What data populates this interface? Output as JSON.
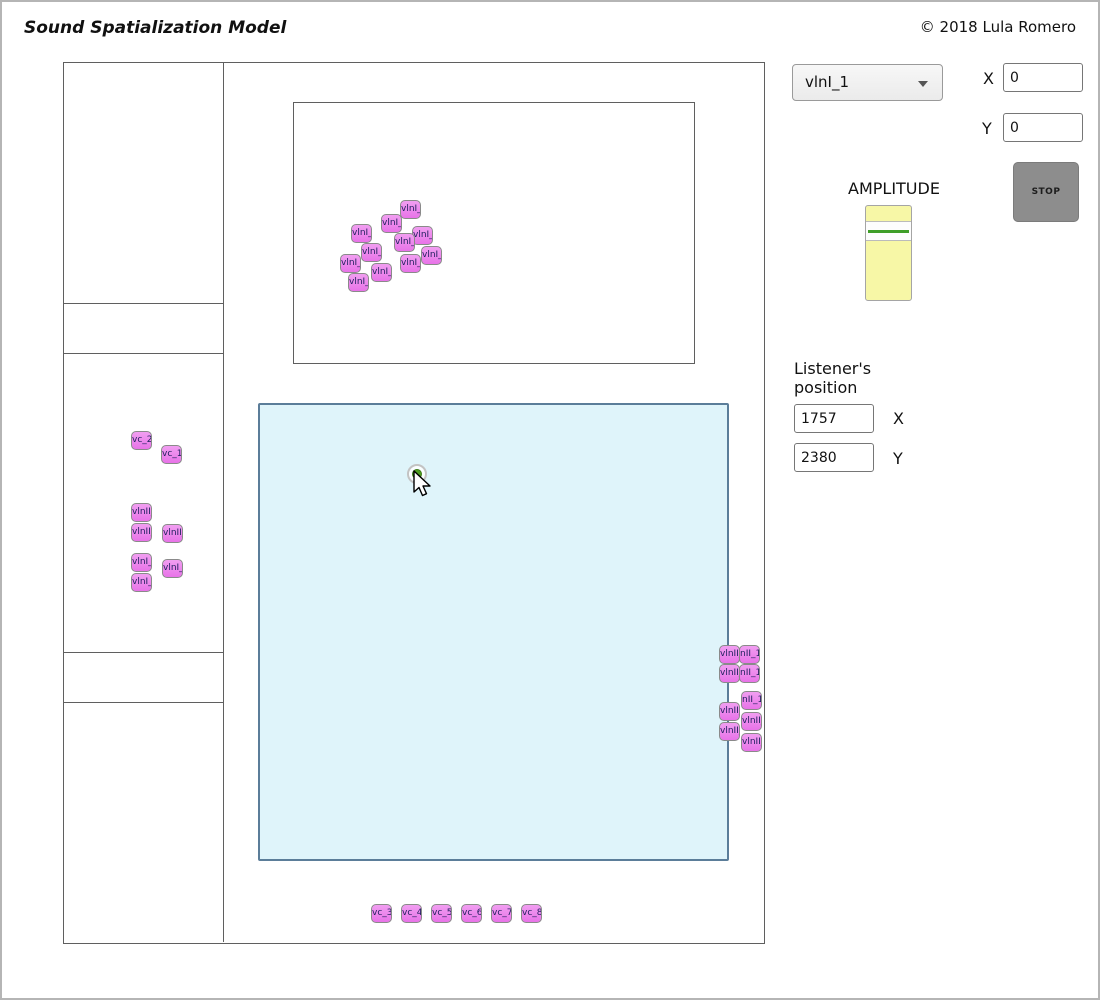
{
  "header": {
    "title": "Sound Spatialization Model",
    "copyright": "© 2018 Lula Romero"
  },
  "source_panel": {
    "selected_source": "vlnI_1",
    "x_label": "X",
    "x_value": "0",
    "y_label": "Y",
    "y_value": "0",
    "amplitude_label": "AMPLITUDE",
    "stop_label": "STOP"
  },
  "listener_panel": {
    "heading": "Listener's position",
    "x_label": "X",
    "x_value": "1757",
    "y_label": "Y",
    "y_value": "2380"
  },
  "colors": {
    "object_fill": "#ee82ee",
    "object_border": "#8a8a8a",
    "object_text": "#1f1f5e",
    "stage_fill": "#dff4fa",
    "stage_border": "#5b7d99",
    "slider_fill": "#f7f7a6",
    "slider_handle_line": "#3f9e28",
    "stop_fill": "#8d8d8d",
    "marker_dot": "#4e9e20",
    "frame_line": "#5f5f5f"
  },
  "sound_objects": [
    {
      "label": "vlnI_1",
      "x": 398,
      "y": 198
    },
    {
      "label": "vlnI_1",
      "x": 379,
      "y": 212
    },
    {
      "label": "vlnI_1",
      "x": 349,
      "y": 222
    },
    {
      "label": "vlnI_1",
      "x": 410,
      "y": 224
    },
    {
      "label": "vlnI_1",
      "x": 392,
      "y": 231
    },
    {
      "label": "vlnI_9",
      "x": 359,
      "y": 241
    },
    {
      "label": "vlnI_7",
      "x": 419,
      "y": 244
    },
    {
      "label": "vlnI_8",
      "x": 338,
      "y": 252
    },
    {
      "label": "vlnI_6",
      "x": 398,
      "y": 252
    },
    {
      "label": "vlnI_5",
      "x": 369,
      "y": 261
    },
    {
      "label": "vlnI_4",
      "x": 346,
      "y": 271
    },
    {
      "label": "vc_2",
      "x": 129,
      "y": 429
    },
    {
      "label": "vc_1",
      "x": 159,
      "y": 443
    },
    {
      "label": "vlnII_3",
      "x": 129,
      "y": 501
    },
    {
      "label": "vlnII_2",
      "x": 129,
      "y": 521
    },
    {
      "label": "vlnII_1",
      "x": 160,
      "y": 522
    },
    {
      "label": "vlnI_3",
      "x": 129,
      "y": 551
    },
    {
      "label": "vlnI_2",
      "x": 129,
      "y": 571
    },
    {
      "label": "vlnI_1",
      "x": 160,
      "y": 557
    },
    {
      "label": "vlnII_1",
      "x": 717,
      "y": 643
    },
    {
      "label": "nII_1",
      "x": 737,
      "y": 643
    },
    {
      "label": "vlnII_4",
      "x": 717,
      "y": 662
    },
    {
      "label": "nII_1",
      "x": 737,
      "y": 662
    },
    {
      "label": "nII_1",
      "x": 739,
      "y": 689
    },
    {
      "label": "vlnII_5",
      "x": 717,
      "y": 700
    },
    {
      "label": "vlnII_9",
      "x": 739,
      "y": 710
    },
    {
      "label": "vlnII_4",
      "x": 717,
      "y": 720
    },
    {
      "label": "vlnII_8",
      "x": 739,
      "y": 731
    },
    {
      "label": "vc_3",
      "x": 369,
      "y": 902
    },
    {
      "label": "vc_4",
      "x": 399,
      "y": 902
    },
    {
      "label": "vc_5",
      "x": 429,
      "y": 902
    },
    {
      "label": "vc_6",
      "x": 459,
      "y": 902
    },
    {
      "label": "vc_7",
      "x": 489,
      "y": 902
    },
    {
      "label": "vc_8",
      "x": 519,
      "y": 902
    }
  ]
}
